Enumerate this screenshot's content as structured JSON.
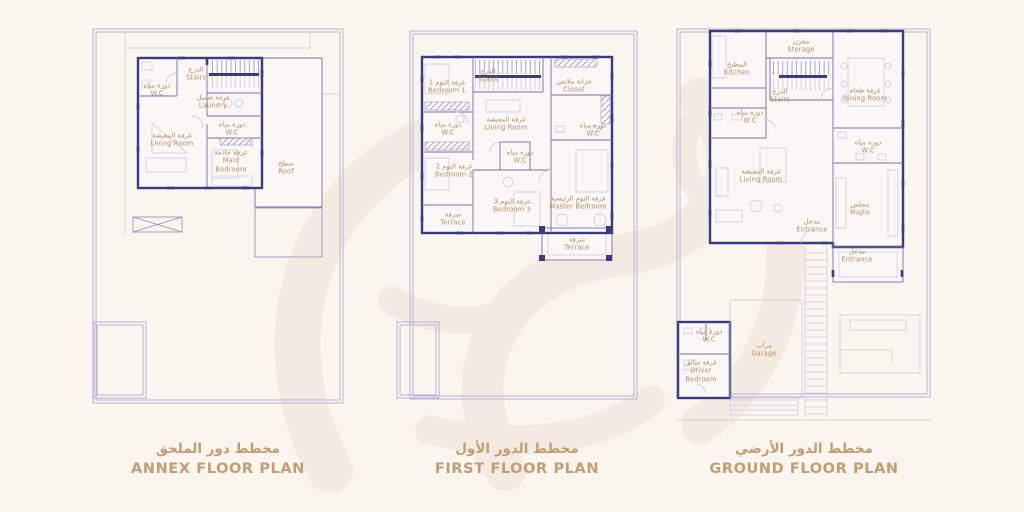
{
  "document": {
    "type": "architectural floor plan sheet",
    "plans_count": 3
  },
  "palette": {
    "background": "#faf5ee",
    "wall_line": "#3e3a82",
    "partition_line": "#7671ab",
    "light_line": "#c9c5e2",
    "boundary_line": "#b7b3d6",
    "room_label_text": "#b98e62",
    "title_text": "#c49c72",
    "watermark": "#f2eae1"
  },
  "watermark": {
    "name": "faint-calligraphy-watermark",
    "color": "#f2eae1"
  },
  "plans": [
    {
      "id": "annex",
      "title_ar": "مخطط دور الملحق",
      "title_en": "ANNEX FLOOR PLAN",
      "rooms": [
        {
          "id": "stairs",
          "ar": "الدرج",
          "en": "Stairs",
          "x": 104,
          "y": 46,
          "w": 40
        },
        {
          "id": "wc-top",
          "ar": "دورة مياه",
          "en": "W.C",
          "x": 65,
          "y": 62,
          "w": 44
        },
        {
          "id": "laundry",
          "ar": "غرفة غسيل",
          "en": "Laundry",
          "x": 121,
          "y": 74,
          "w": 48
        },
        {
          "id": "wc-mid",
          "ar": "دورة مياه",
          "en": "W.C",
          "x": 140,
          "y": 101,
          "w": 44
        },
        {
          "id": "living-room",
          "ar": "غرفة المعيشة",
          "en": "Living Room",
          "x": 80,
          "y": 112,
          "w": 60
        },
        {
          "id": "maid-bedroom",
          "ar": "غرفة خادمة",
          "en": "Maid Bedroom",
          "x": 139,
          "y": 133,
          "w": 40
        },
        {
          "id": "roof",
          "ar": "سطح",
          "en": "Roof",
          "x": 194,
          "y": 140,
          "w": 40
        }
      ]
    },
    {
      "id": "first-floor",
      "title_ar": "مخطط الدور الأول",
      "title_en": "FIRST FLOOR PLAN",
      "rooms": [
        {
          "id": "bedroom-1",
          "ar": "غرفة النوم 1",
          "en": "Bedroom 1",
          "x": 51,
          "y": 57,
          "w": 54
        },
        {
          "id": "stairs",
          "ar": "الدرج",
          "en": "Stairs",
          "x": 92,
          "y": 46,
          "w": 40
        },
        {
          "id": "closet",
          "ar": "خزانة ملابس",
          "en": "Closet",
          "x": 178,
          "y": 56,
          "w": 56
        },
        {
          "id": "wc-left",
          "ar": "دورة مياه",
          "en": "W.C",
          "x": 52,
          "y": 99,
          "w": 44
        },
        {
          "id": "living-room",
          "ar": "غرفة المعيشة",
          "en": "Living Room",
          "x": 110,
          "y": 94,
          "w": 60
        },
        {
          "id": "wc-right",
          "ar": "دورة مياه",
          "en": "W.C",
          "x": 197,
          "y": 100,
          "w": 44
        },
        {
          "id": "wc-middle",
          "ar": "دورة مياه",
          "en": "W.C",
          "x": 124,
          "y": 127,
          "w": 44
        },
        {
          "id": "bedroom-2",
          "ar": "غرفة النوم 2",
          "en": "Bedroom 2",
          "x": 58,
          "y": 141,
          "w": 54
        },
        {
          "id": "bedroom-3",
          "ar": "غرفة النوم 3",
          "en": "Bedroom 3",
          "x": 116,
          "y": 176,
          "w": 54
        },
        {
          "id": "master-bedroom",
          "ar": "غرفة النوم الرئيسية",
          "en": "Master Bedroom",
          "x": 182,
          "y": 173,
          "w": 72
        },
        {
          "id": "terrace-left",
          "ar": "شرفة",
          "en": "Terrace",
          "x": 57,
          "y": 189,
          "w": 44
        },
        {
          "id": "terrace-bottom",
          "ar": "شرفة",
          "en": "Terrace",
          "x": 181,
          "y": 214,
          "w": 44
        }
      ]
    },
    {
      "id": "ground-floor",
      "title_ar": "مخطط الدور الأرضي",
      "title_en": "GROUND FLOOR PLAN",
      "rooms": [
        {
          "id": "storage",
          "ar": "مخزن",
          "en": "Storage",
          "x": 125,
          "y": 18,
          "w": 44
        },
        {
          "id": "kitchen",
          "ar": "المطبخ",
          "en": "Kitchen",
          "x": 61,
          "y": 41,
          "w": 48
        },
        {
          "id": "stairs",
          "ar": "الدرج",
          "en": "Stairs",
          "x": 104,
          "y": 68,
          "w": 40
        },
        {
          "id": "dining-room",
          "ar": "غرفة طعام",
          "en": "Dining Room",
          "x": 189,
          "y": 67,
          "w": 56
        },
        {
          "id": "wc-left",
          "ar": "دورة مياه",
          "en": "W.C",
          "x": 74,
          "y": 89,
          "w": 44
        },
        {
          "id": "wc-right",
          "ar": "دورة مياه",
          "en": "W.C",
          "x": 192,
          "y": 119,
          "w": 44
        },
        {
          "id": "living-room",
          "ar": "غرفة المعيشة",
          "en": "Living Room",
          "x": 85,
          "y": 148,
          "w": 60
        },
        {
          "id": "majlis",
          "ar": "مجلس",
          "en": "Majlis",
          "x": 184,
          "y": 181,
          "w": 44
        },
        {
          "id": "entrance-main",
          "ar": "مدخل",
          "en": "Entrance",
          "x": 136,
          "y": 198,
          "w": 48
        },
        {
          "id": "entrance-porch",
          "ar": "مدخل",
          "en": "Entrance",
          "x": 181,
          "y": 228,
          "w": 48
        },
        {
          "id": "wc-garage",
          "ar": "دورة مياه",
          "en": "W.C",
          "x": 33,
          "y": 308,
          "w": 44
        },
        {
          "id": "garage",
          "ar": "مرآب",
          "en": "Garage",
          "x": 88,
          "y": 322,
          "w": 44
        },
        {
          "id": "driver-bedroom",
          "ar": "غرفة سائق",
          "en": "Driver Bedroom",
          "x": 25,
          "y": 343,
          "w": 40
        }
      ]
    }
  ]
}
